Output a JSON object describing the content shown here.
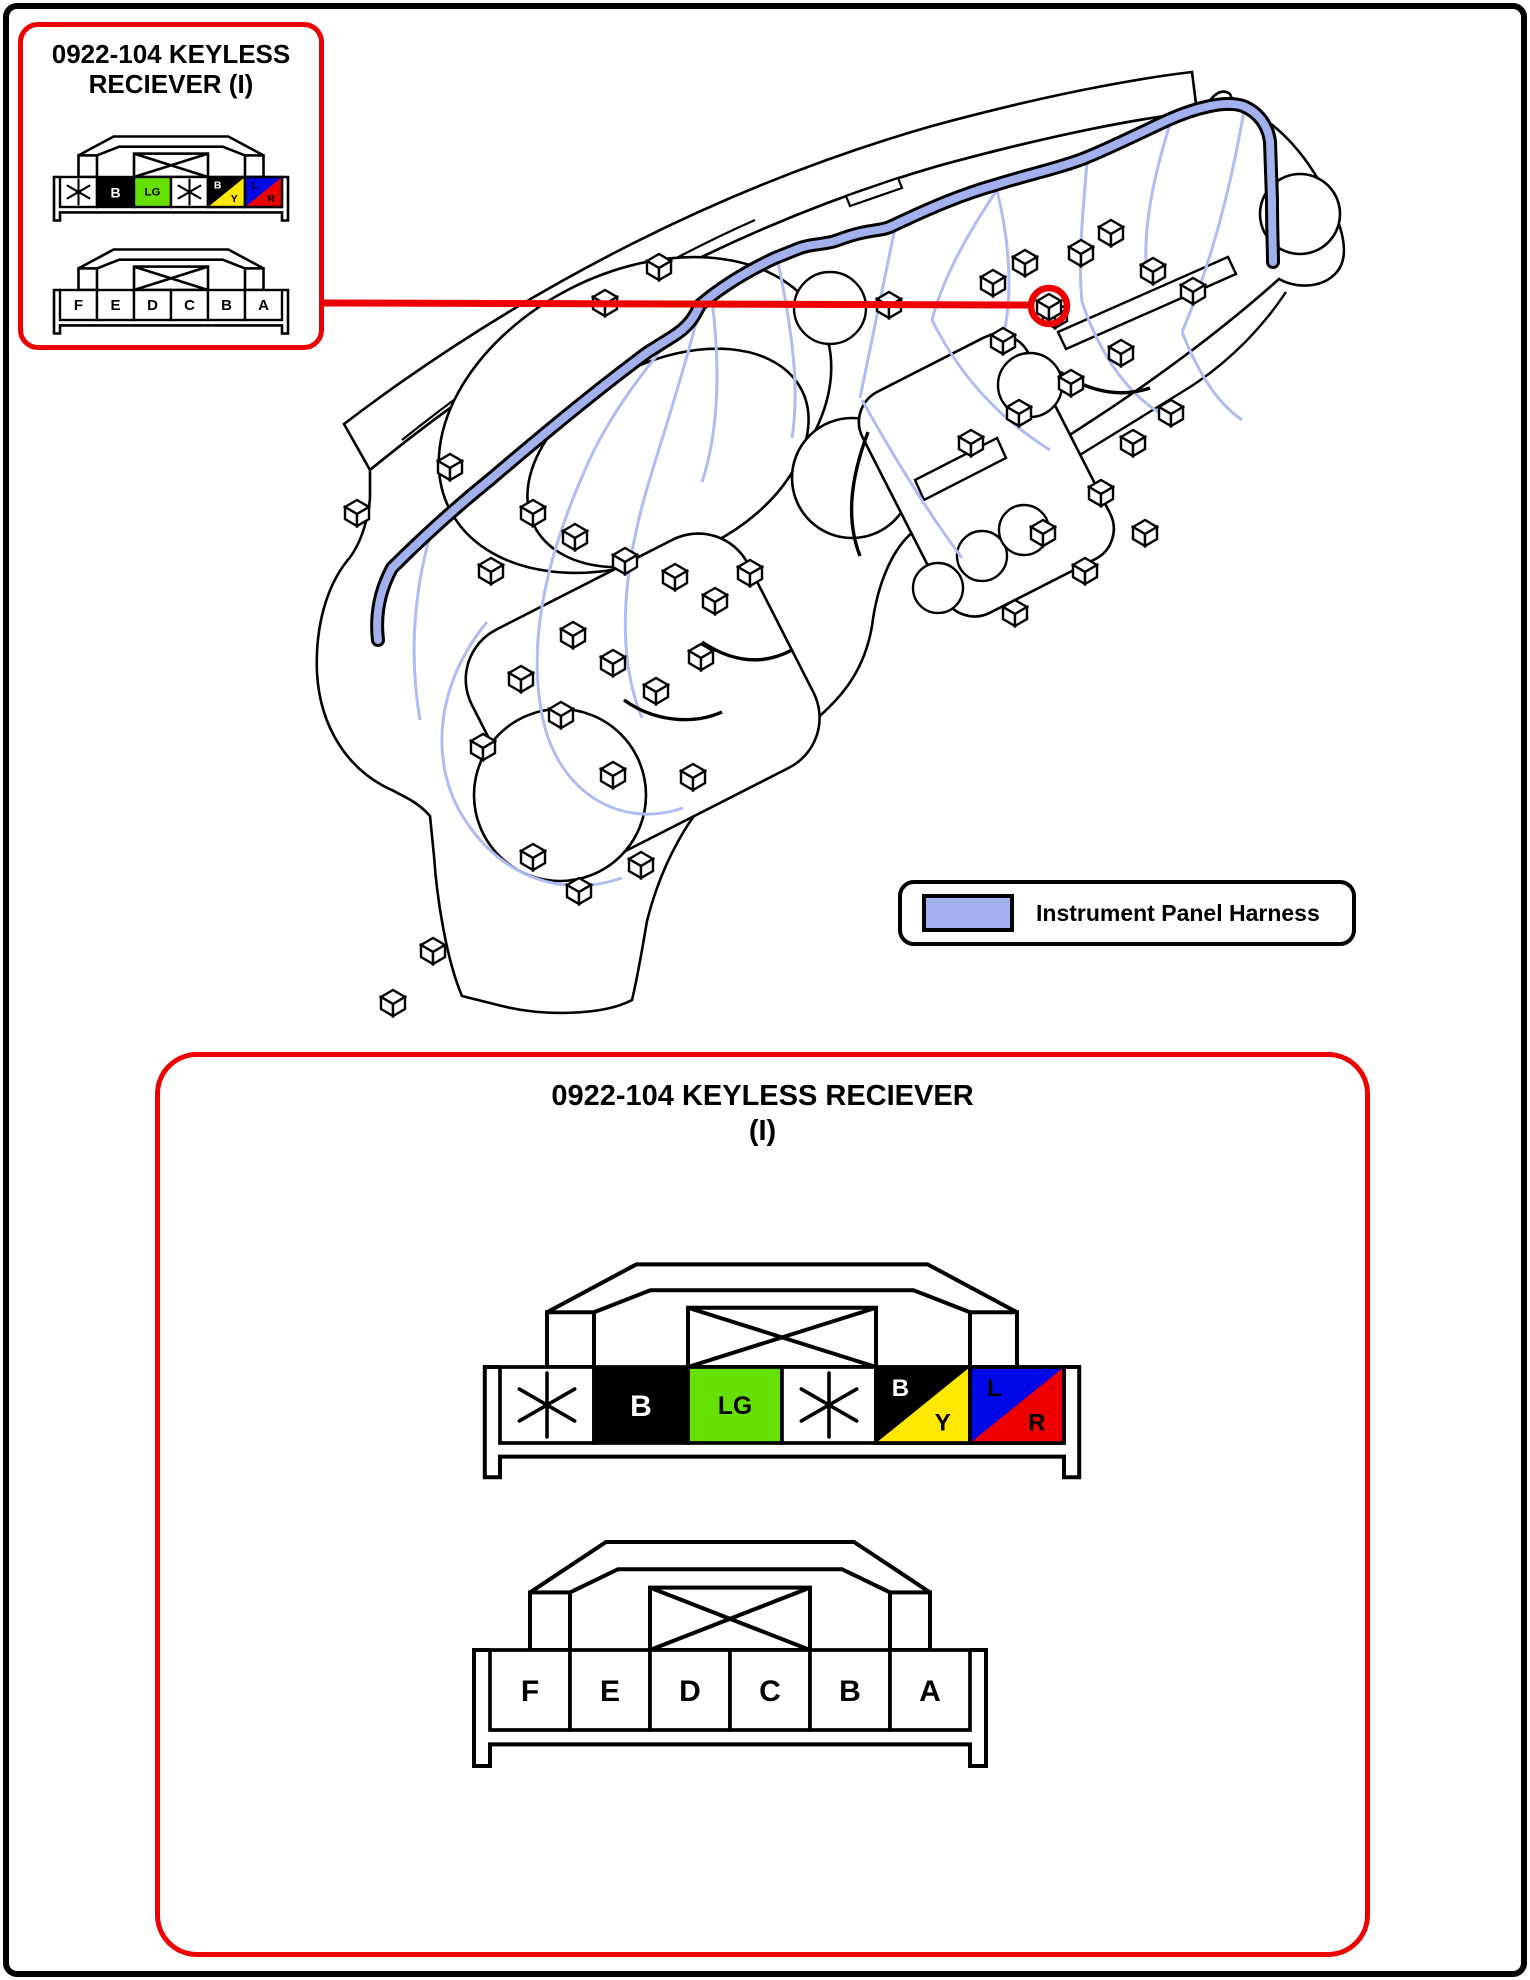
{
  "inset": {
    "title_line1": "0922-104 KEYLESS",
    "title_line2": "RECIEVER (I)"
  },
  "detail": {
    "title_line1": "0922-104 KEYLESS RECIEVER",
    "title_line2": "(I)"
  },
  "legend": {
    "label": "Instrument Panel Harness",
    "swatch_color": "#a2b0ee"
  },
  "colors": {
    "annotation_red": "#ee0000",
    "harness_fill": "#a2b0ee",
    "wire_blue": "#b0bcf2",
    "outline_black": "#000000"
  },
  "connectors": {
    "wire_side": {
      "description": "keyless receiver connector wire colors",
      "pins": [
        {
          "type": "star"
        },
        {
          "type": "solid",
          "label": "B",
          "bg": "#000000",
          "fg": "#ffffff"
        },
        {
          "type": "solid",
          "label": "LG",
          "bg": "#66e000",
          "fg": "#000000"
        },
        {
          "type": "star"
        },
        {
          "type": "split",
          "label_top": "B",
          "bg_top": "#000000",
          "fg_top": "#ffffff",
          "label_bottom": "Y",
          "bg_bottom": "#ffe800",
          "fg_bottom": "#000000"
        },
        {
          "type": "split",
          "label_top": "L",
          "bg_top": "#0008e8",
          "fg_top": "#000000",
          "label_bottom": "R",
          "bg_bottom": "#ee0000",
          "fg_bottom": "#000000"
        }
      ]
    },
    "pin_side": {
      "description": "keyless receiver connector pin letters",
      "pins": [
        {
          "type": "plain",
          "label": "F"
        },
        {
          "type": "plain",
          "label": "E"
        },
        {
          "type": "plain",
          "label": "D"
        },
        {
          "type": "plain",
          "label": "C"
        },
        {
          "type": "plain",
          "label": "B"
        },
        {
          "type": "plain",
          "label": "A"
        }
      ]
    }
  }
}
